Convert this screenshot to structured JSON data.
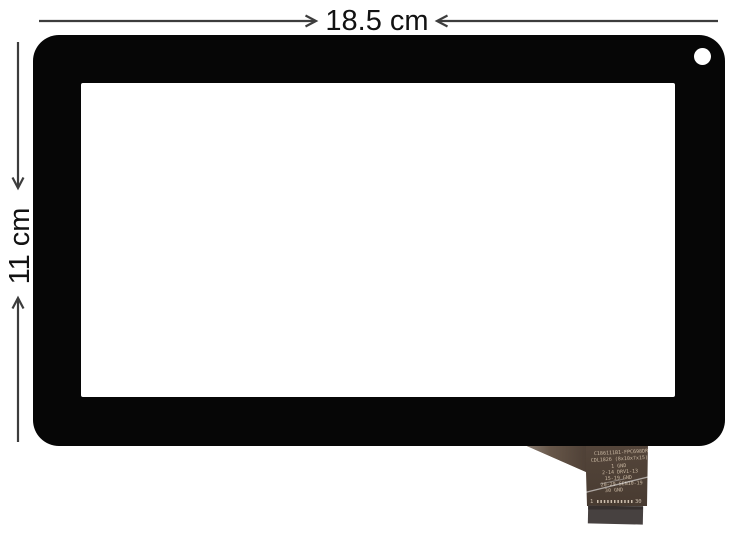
{
  "product": {
    "description": "tablet touch screen digitizer photo",
    "width_label": "18.5 cm",
    "height_label": "11 cm"
  },
  "cable": {
    "lines": [
      "C186111B1-FPC698DR",
      "CDL1826 (8x10x7x15)",
      "1 GND",
      "2-14 DRV1-13",
      "15-19 GND",
      "20-29 SEN10-19",
      "30 GND"
    ],
    "pin_first": "1",
    "pin_last": "30"
  },
  "colors": {
    "background": "#ffffff",
    "frame": "#060606",
    "screen": "#ffffff",
    "dimension": "#3d3d3d",
    "cable_body": "#4e4036",
    "cable_flare_light": "#a1968c",
    "cable_text": "#c8b7a2",
    "connector": "#474140"
  }
}
